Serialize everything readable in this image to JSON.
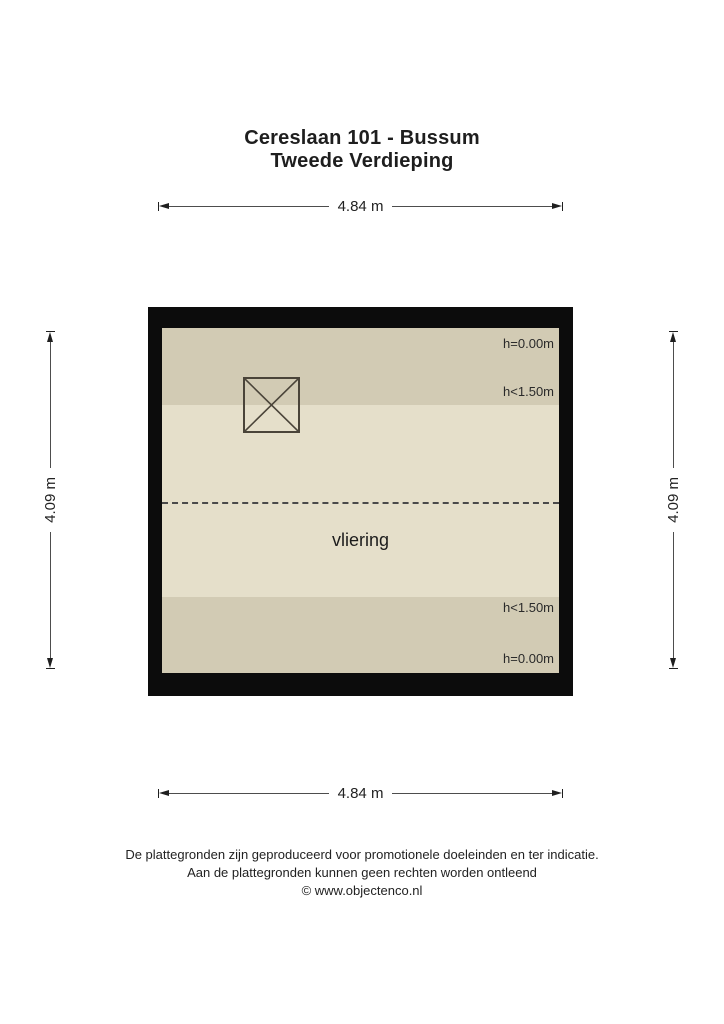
{
  "title": {
    "line1": "Cereslaan 101 - Bussum",
    "line2": "Tweede Verdieping"
  },
  "dimensions": {
    "top": "4.84 m",
    "bottom": "4.84 m",
    "left": "4.09 m",
    "right": "4.09 m"
  },
  "floor_plan": {
    "room_label": "vliering",
    "height_labels": {
      "top_wall": "h=0.00m",
      "top_zone": "h<1.50m",
      "bottom_zone": "h<1.50m",
      "bottom_wall": "h=0.00m"
    },
    "symbols": [
      "crossed-square"
    ],
    "colors": {
      "wall": "#0c0c0c",
      "low_height_zone": "#d2cbb4",
      "floor": "#e5dfca"
    }
  },
  "footer": {
    "line1": "De plattegronden zijn geproduceerd voor promotionele doeleinden en ter indicatie.",
    "line2": "Aan de plattegronden kunnen geen rechten worden ontleend",
    "line3": "© www.objectenco.nl"
  }
}
